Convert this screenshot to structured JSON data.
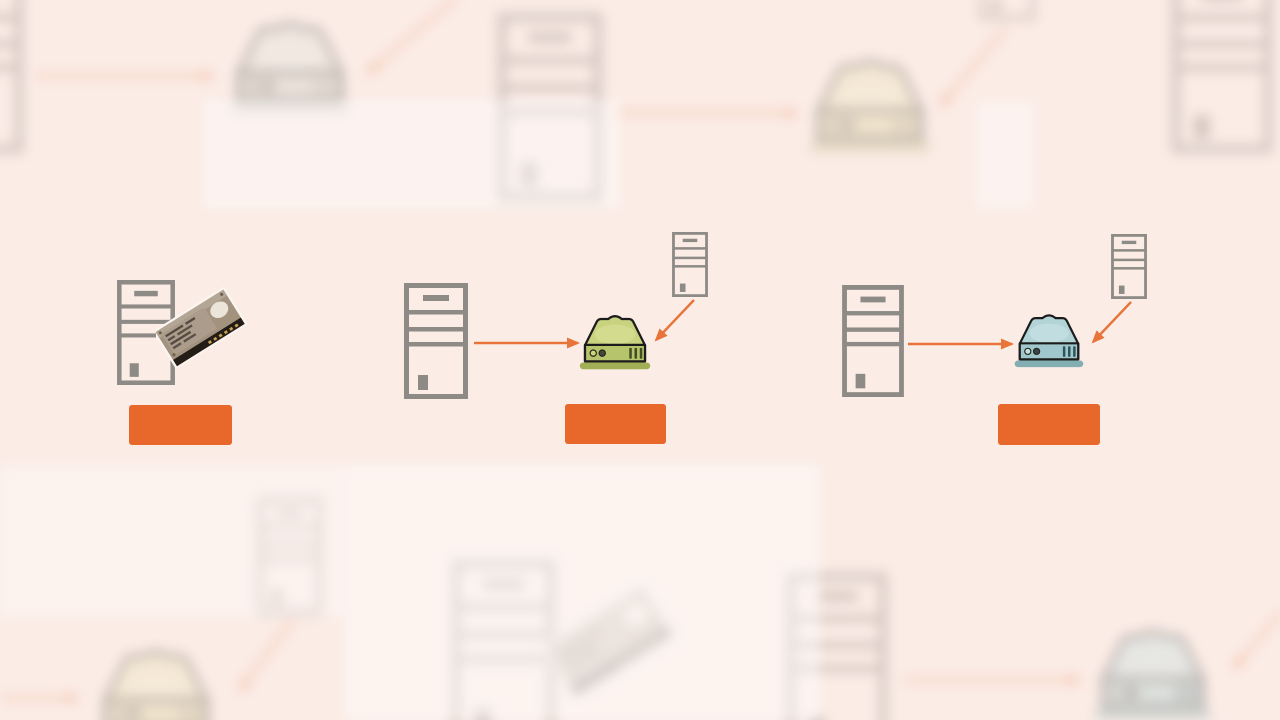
{
  "canvas": {
    "width": 1280,
    "height": 720,
    "background": "#fbece6"
  },
  "colors": {
    "label_bar": "#e8672a",
    "arrow": "#e8743a",
    "tower_outline": "#8e8a86",
    "nas_green_top": "#c9d37f",
    "nas_green_front": "#b6c56b",
    "nas_teal_top": "#b2d4d7",
    "nas_teal_front": "#a0c8cc",
    "nas_outline": "#1c1c1c",
    "hdd_top": "#a3927e",
    "hdd_edge": "#241d17"
  },
  "groups": [
    {
      "id": "tower-with-internal-hard-disk",
      "icons": [
        "desktop-tower-icon",
        "hard-disk-drive-icon"
      ],
      "label_text": ""
    },
    {
      "id": "towers-connected-to-green-nas",
      "icons": [
        "desktop-tower-icon",
        "green-nas-box-icon",
        "small-desktop-tower-icon"
      ],
      "arrows": [
        "tower-to-nas",
        "small-tower-to-nas"
      ],
      "label_text": ""
    },
    {
      "id": "towers-connected-to-teal-nas",
      "icons": [
        "desktop-tower-icon",
        "teal-nas-box-icon",
        "small-desktop-tower-icon"
      ],
      "arrows": [
        "tower-to-nas",
        "small-tower-to-nas"
      ],
      "label_text": ""
    }
  ],
  "background_layer": {
    "style": "blurred-faded-copies-of-same-illustrations",
    "icons": [
      "desktop-tower-icon",
      "gray-nas-box-icon",
      "yellow-nas-box-icon",
      "teal-nas-box-icon",
      "hard-disk-drive-icon",
      "orange-arrow"
    ]
  }
}
